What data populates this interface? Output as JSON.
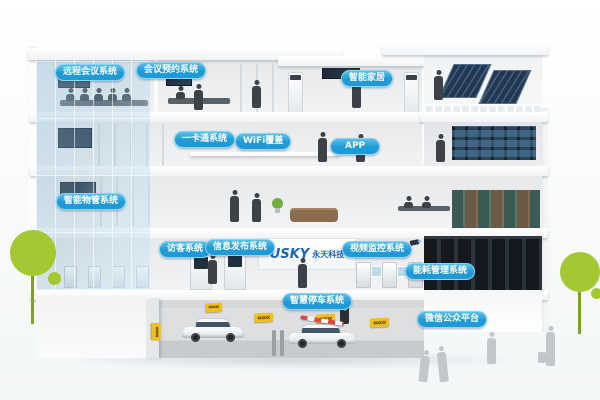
{
  "scene": {
    "description": "Isometric cutaway illustration of a smart building with labeled intelligent-building systems, parking garage, rooftop solar panels, trees and people",
    "colors": {
      "sky_top": "#7fc6ea",
      "sky_bottom": "#e4f4fc",
      "label_blue": "#1e9ad6",
      "label_border": "#8ed4f2",
      "tree_green": "#a4c832",
      "sign_yellow": "#f0c01d",
      "logo_blue": "#1b63b5"
    }
  },
  "labels": {
    "remote_conference": "远程会议系统",
    "meeting_reservation": "会议预约系统",
    "smart_home": "智能家居",
    "one_card": "一卡通系统",
    "wifi_coverage": "WiFi覆盖",
    "app": "APP",
    "property_mgmt": "智能物管系统",
    "visitor": "访客系统",
    "info_publish": "信息发布系统",
    "video_surveillance": "视频监控系统",
    "energy_mgmt": "能耗管理系统",
    "smart_parking": "智慧停车系统",
    "wechat_platform": "微信公众平台"
  },
  "logo": {
    "brand": "USKY",
    "company": "永天科技"
  },
  "icons": {
    "chevrons": "«««"
  }
}
